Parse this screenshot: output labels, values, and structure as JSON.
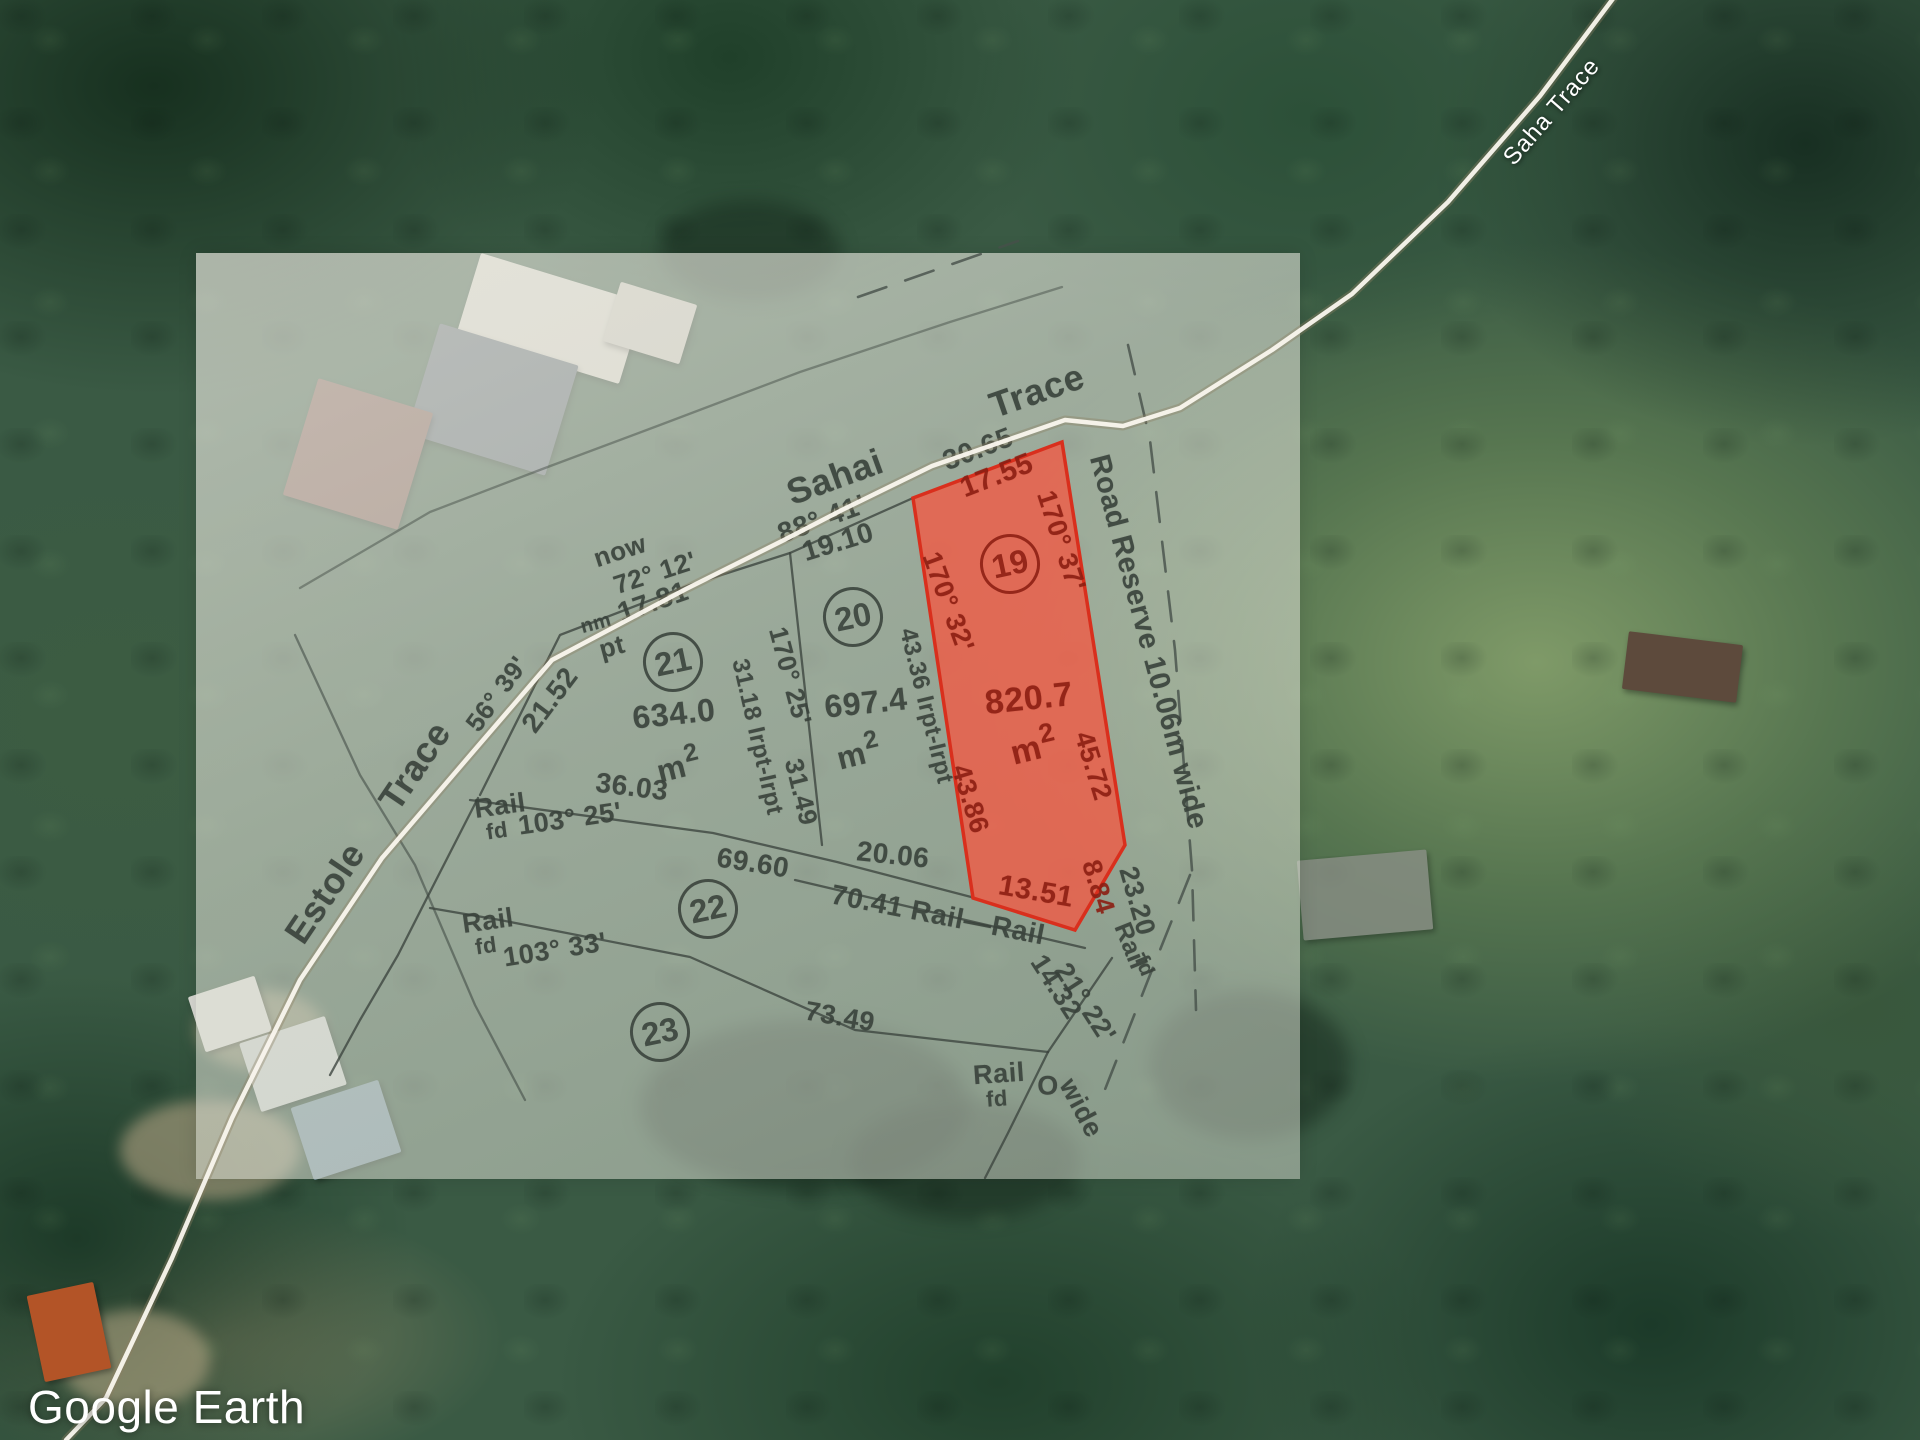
{
  "app": {
    "watermark": "Google Earth"
  },
  "satellite": {
    "road_label": {
      "t": "Saha Trace",
      "x": 1552,
      "y": 112,
      "r": -49,
      "s": 24
    }
  },
  "plan": {
    "parcels": [
      {
        "num": "19",
        "x": 1010,
        "y": 564,
        "highlighted": true,
        "area": {
          "value": "820.7",
          "x": 1029,
          "y": 699,
          "r": -6,
          "s": 34,
          "unit": "m",
          "sup": "2",
          "ux": 1033,
          "uy": 746
        }
      },
      {
        "num": "20",
        "x": 853,
        "y": 617,
        "highlighted": false,
        "area": {
          "value": "697.4",
          "x": 866,
          "y": 703,
          "r": -6,
          "s": 32,
          "unit": "m",
          "sup": "2",
          "ux": 858,
          "uy": 752
        }
      },
      {
        "num": "21",
        "x": 673,
        "y": 662,
        "highlighted": false,
        "area": {
          "value": "634.0",
          "x": 674,
          "y": 714,
          "r": -6,
          "s": 32,
          "unit": "m",
          "sup": "2",
          "ux": 678,
          "uy": 765
        }
      },
      {
        "num": "22",
        "x": 708,
        "y": 909,
        "highlighted": false
      },
      {
        "num": "23",
        "x": 660,
        "y": 1032,
        "highlighted": false
      }
    ],
    "labels": [
      {
        "t": "Sahai",
        "x": 835,
        "y": 477,
        "r": -20,
        "s": 36,
        "c": "g"
      },
      {
        "t": "Trace",
        "x": 1037,
        "y": 391,
        "r": -19,
        "s": 36,
        "c": "g"
      },
      {
        "t": "30.65",
        "x": 978,
        "y": 449,
        "r": -21,
        "s": 28,
        "c": "g"
      },
      {
        "t": "88° 41'",
        "x": 822,
        "y": 519,
        "r": -20,
        "s": 28,
        "c": "g"
      },
      {
        "t": "19.10",
        "x": 838,
        "y": 542,
        "r": -17,
        "s": 28,
        "c": "g"
      },
      {
        "t": "now",
        "x": 620,
        "y": 551,
        "r": -18,
        "s": 26,
        "c": "g"
      },
      {
        "t": "72° 12'",
        "x": 655,
        "y": 573,
        "r": -18,
        "s": 26,
        "c": "g"
      },
      {
        "t": "17.81",
        "x": 653,
        "y": 602,
        "r": -19,
        "s": 28,
        "c": "g"
      },
      {
        "t": "nm",
        "x": 596,
        "y": 624,
        "r": -15,
        "s": 20,
        "c": "g"
      },
      {
        "t": "pt",
        "x": 612,
        "y": 647,
        "r": -15,
        "s": 26,
        "c": "g"
      },
      {
        "t": "56° 39'",
        "x": 497,
        "y": 694,
        "r": -54,
        "s": 26,
        "c": "g"
      },
      {
        "t": "21.52",
        "x": 550,
        "y": 700,
        "r": -53,
        "s": 28,
        "c": "g"
      },
      {
        "t": "Trace",
        "x": 415,
        "y": 766,
        "r": -56,
        "s": 36,
        "c": "g"
      },
      {
        "t": "Estole",
        "x": 325,
        "y": 893,
        "r": -56,
        "s": 36,
        "c": "g"
      },
      {
        "t": "Rail",
        "x": 500,
        "y": 806,
        "r": -8,
        "s": 27,
        "c": "g"
      },
      {
        "t": "fd",
        "x": 497,
        "y": 831,
        "r": -8,
        "s": 22,
        "c": "g"
      },
      {
        "t": "103° 25'",
        "x": 570,
        "y": 819,
        "r": -8,
        "s": 27,
        "c": "g"
      },
      {
        "t": "36.03",
        "x": 632,
        "y": 787,
        "r": 7,
        "s": 28,
        "c": "g"
      },
      {
        "t": "Rail",
        "x": 488,
        "y": 921,
        "r": -8,
        "s": 27,
        "c": "g"
      },
      {
        "t": "fd",
        "x": 486,
        "y": 946,
        "r": -8,
        "s": 22,
        "c": "g"
      },
      {
        "t": "103° 33'",
        "x": 555,
        "y": 950,
        "r": -9,
        "s": 27,
        "c": "g"
      },
      {
        "t": "31.18 Irpt-Irpt",
        "x": 757,
        "y": 737,
        "r": 77,
        "s": 24,
        "c": "g"
      },
      {
        "t": "170° 25'",
        "x": 790,
        "y": 676,
        "r": 75,
        "s": 26,
        "c": "g"
      },
      {
        "t": "31.49",
        "x": 801,
        "y": 792,
        "r": 76,
        "s": 26,
        "c": "g"
      },
      {
        "t": "43.36 Irpt-Irpt",
        "x": 926,
        "y": 706,
        "r": 76,
        "s": 24,
        "c": "g"
      },
      {
        "t": "69.60",
        "x": 753,
        "y": 863,
        "r": 9,
        "s": 28,
        "c": "g"
      },
      {
        "t": "20.06",
        "x": 893,
        "y": 855,
        "r": 6,
        "s": 28,
        "c": "g"
      },
      {
        "t": "70.41 Rail—Rail",
        "x": 938,
        "y": 915,
        "r": 11,
        "s": 28,
        "c": "g"
      },
      {
        "t": "73.49",
        "x": 840,
        "y": 1017,
        "r": 10,
        "s": 27,
        "c": "g"
      },
      {
        "t": "Rail",
        "x": 999,
        "y": 1074,
        "r": -4,
        "s": 27,
        "c": "g"
      },
      {
        "t": "fd",
        "x": 997,
        "y": 1099,
        "r": -4,
        "s": 22,
        "c": "g"
      },
      {
        "t": "O",
        "x": 1048,
        "y": 1086,
        "r": 0,
        "s": 27,
        "c": "g"
      },
      {
        "t": "14.32",
        "x": 1056,
        "y": 987,
        "r": 57,
        "s": 27,
        "c": "g"
      },
      {
        "t": "21° 22'",
        "x": 1085,
        "y": 1003,
        "r": 57,
        "s": 27,
        "c": "g"
      },
      {
        "t": "wide",
        "x": 1081,
        "y": 1108,
        "r": 62,
        "s": 27,
        "c": "g"
      },
      {
        "t": "23.20",
        "x": 1137,
        "y": 901,
        "r": 74,
        "s": 27,
        "c": "g"
      },
      {
        "t": "Rail",
        "x": 1130,
        "y": 946,
        "r": 68,
        "s": 25,
        "c": "g"
      },
      {
        "t": "fd",
        "x": 1144,
        "y": 966,
        "r": 68,
        "s": 21,
        "c": "g"
      },
      {
        "t": "Road Reserve 10.06m wide",
        "x": 1148,
        "y": 642,
        "r": 75,
        "s": 29,
        "c": "g"
      },
      {
        "t": "17.55",
        "x": 997,
        "y": 476,
        "r": -21,
        "s": 29,
        "c": "r"
      },
      {
        "t": "170° 37'",
        "x": 1061,
        "y": 541,
        "r": 72,
        "s": 27,
        "c": "r"
      },
      {
        "t": "170° 32'",
        "x": 948,
        "y": 602,
        "r": 70,
        "s": 27,
        "c": "r"
      },
      {
        "t": "43.86",
        "x": 970,
        "y": 799,
        "r": 73,
        "s": 27,
        "c": "r"
      },
      {
        "t": "45.72",
        "x": 1093,
        "y": 766,
        "r": 73,
        "s": 27,
        "c": "r"
      },
      {
        "t": "13.51",
        "x": 1036,
        "y": 892,
        "r": 10,
        "s": 29,
        "c": "r"
      },
      {
        "t": "8.84",
        "x": 1098,
        "y": 887,
        "r": 73,
        "s": 27,
        "c": "r"
      }
    ]
  }
}
